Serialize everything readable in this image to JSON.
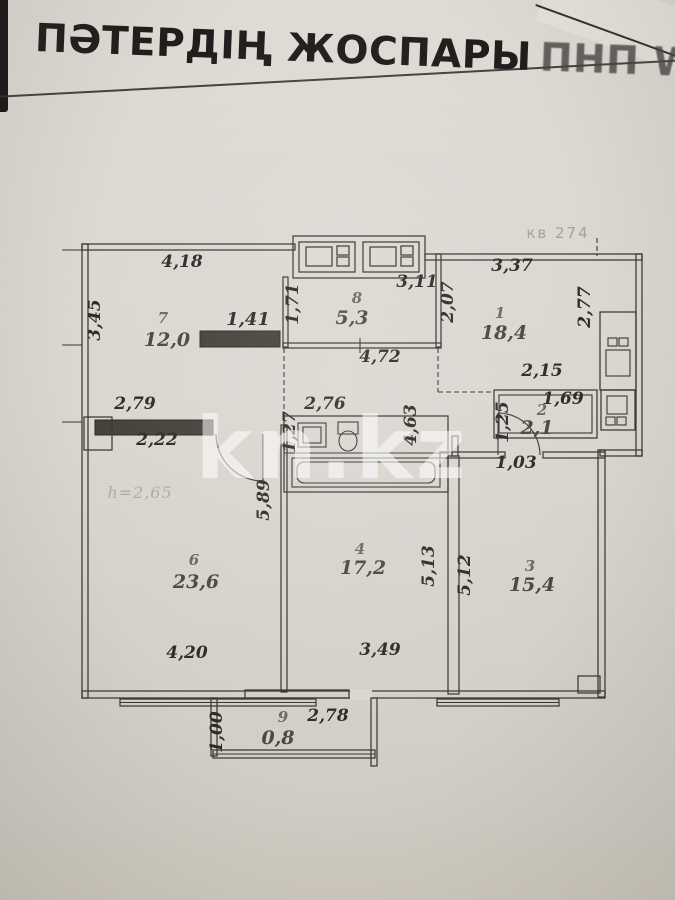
{
  "page": {
    "title": "ПӘТЕРДІҢ ЖОСПАРЫ",
    "title_overlap": "ПНП W ЕӘV АЙ",
    "watermark": "kn.kz",
    "apartment_note": "кв 274",
    "ceiling_height_note": "h=2,65"
  },
  "colors": {
    "paper": "#d9d5cf",
    "ink": "#3a3733",
    "dimension_text": "#2e2b27",
    "wall_fill": "#45403a",
    "watermark_text": "rgba(255,255,255,0.55)"
  },
  "plan": {
    "rooms": [
      {
        "number": "7",
        "area": "12,0",
        "number_pos": [
          163,
          323
        ],
        "area_pos": [
          167,
          346
        ]
      },
      {
        "number": "8",
        "area": "5,3",
        "number_pos": [
          357,
          303
        ],
        "area_pos": [
          352,
          324
        ]
      },
      {
        "number": "1",
        "area": "18,4",
        "number_pos": [
          500,
          318
        ],
        "area_pos": [
          504,
          339
        ]
      },
      {
        "number": "2",
        "area": "2,1",
        "number_pos": [
          542,
          415
        ],
        "area_pos": [
          537,
          434
        ]
      },
      {
        "number": "6",
        "area": "23,6",
        "number_pos": [
          194,
          565
        ],
        "area_pos": [
          196,
          588
        ]
      },
      {
        "number": "4",
        "area": "17,2",
        "number_pos": [
          360,
          554
        ],
        "area_pos": [
          363,
          574
        ]
      },
      {
        "number": "3",
        "area": "15,4",
        "number_pos": [
          530,
          571
        ],
        "area_pos": [
          532,
          591
        ]
      },
      {
        "number": "9",
        "area": "0,8",
        "number_pos": [
          283,
          722
        ],
        "area_pos": [
          278,
          744
        ]
      }
    ],
    "dimensions_horizontal": [
      {
        "text": "4,18",
        "pos": [
          182,
          267
        ]
      },
      {
        "text": "1,41",
        "pos": [
          248,
          325
        ],
        "emphasis": true
      },
      {
        "text": "3,11",
        "pos": [
          417,
          287
        ]
      },
      {
        "text": "3,37",
        "pos": [
          512,
          271
        ]
      },
      {
        "text": "4,72",
        "pos": [
          380,
          362
        ]
      },
      {
        "text": "2,15",
        "pos": [
          542,
          376
        ]
      },
      {
        "text": "1,69",
        "pos": [
          563,
          404
        ]
      },
      {
        "text": "2,79",
        "pos": [
          135,
          409
        ]
      },
      {
        "text": "2,76",
        "pos": [
          325,
          409
        ]
      },
      {
        "text": "2,22",
        "pos": [
          157,
          445
        ]
      },
      {
        "text": "1,03",
        "pos": [
          516,
          468
        ]
      },
      {
        "text": "4,20",
        "pos": [
          187,
          658
        ]
      },
      {
        "text": "3,49",
        "pos": [
          380,
          655
        ]
      },
      {
        "text": "2,78",
        "pos": [
          328,
          721
        ]
      }
    ],
    "dimensions_vertical": [
      {
        "text": "3,45",
        "pos": [
          100,
          320
        ]
      },
      {
        "text": "1,71",
        "pos": [
          298,
          304
        ]
      },
      {
        "text": "2,07",
        "pos": [
          453,
          302
        ]
      },
      {
        "text": "2,77",
        "pos": [
          590,
          307
        ]
      },
      {
        "text": "1,25",
        "pos": [
          508,
          422
        ]
      },
      {
        "text": "4,63",
        "pos": [
          416,
          425
        ]
      },
      {
        "text": "1,27",
        "pos": [
          295,
          432
        ]
      },
      {
        "text": "5,89",
        "pos": [
          269,
          500
        ]
      },
      {
        "text": "5,13",
        "pos": [
          434,
          566
        ]
      },
      {
        "text": "5,12",
        "pos": [
          470,
          575
        ]
      },
      {
        "text": "1,00",
        "pos": [
          222,
          732
        ]
      }
    ]
  }
}
